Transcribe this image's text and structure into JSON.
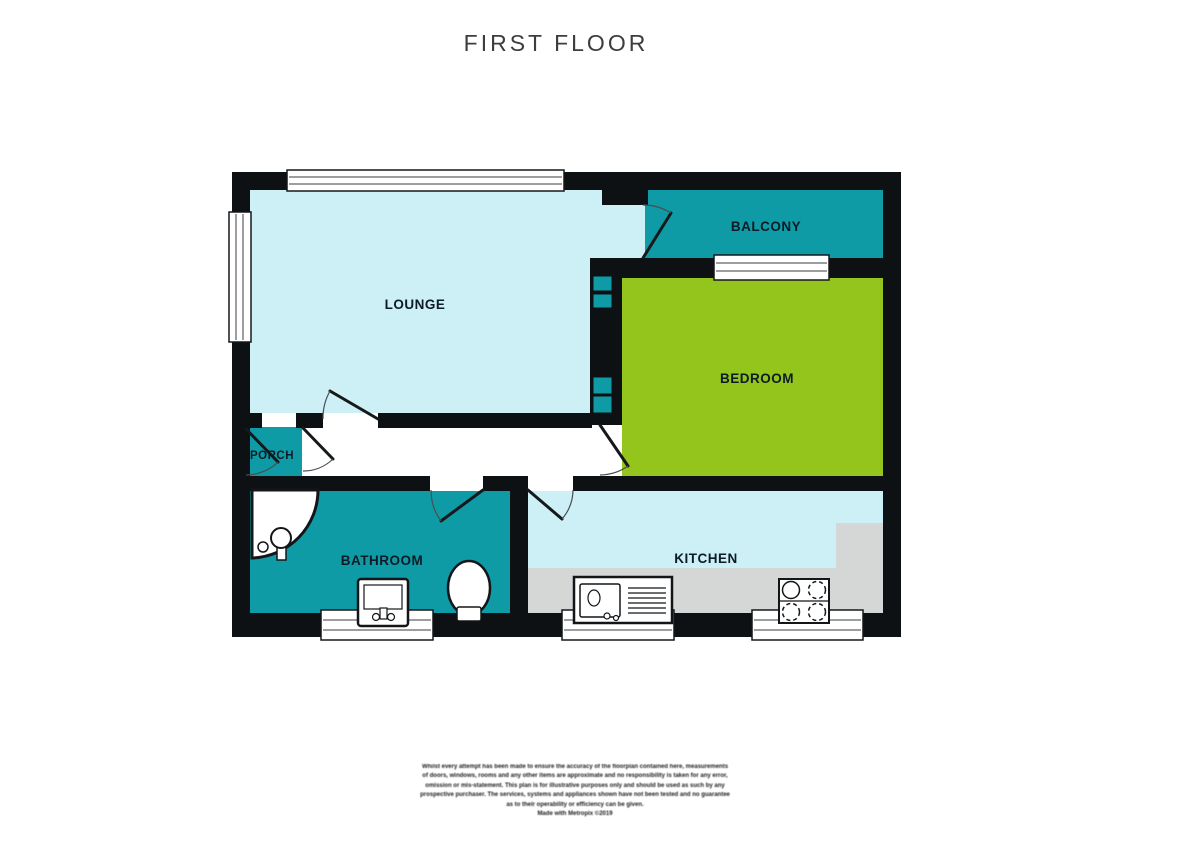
{
  "title": "FIRST FLOOR",
  "rooms": [
    {
      "id": "lounge",
      "label": "LOUNGE"
    },
    {
      "id": "balcony",
      "label": "BALCONY"
    },
    {
      "id": "bedroom",
      "label": "BEDROOM"
    },
    {
      "id": "porch",
      "label": "PORCH"
    },
    {
      "id": "bathroom",
      "label": "BATHROOM"
    },
    {
      "id": "kitchen",
      "label": "KITCHEN"
    }
  ],
  "fixtures": [
    "shower-icon",
    "bath-sink-icon",
    "toilet-icon",
    "kitchen-sink-icon",
    "hob-icon",
    "built-in-cupboards",
    "window-symbols",
    "door-swing-symbols"
  ],
  "colors": {
    "room_cyan": "#cdeff6",
    "room_teal": "#0e9ba6",
    "room_green": "#93c51c",
    "counter_gray": "#d5d7d7",
    "wall_black": "#0d1114",
    "label_ink": "#0d1b26",
    "title_ink": "#3d3d3d"
  },
  "disclaimer": {
    "lines": [
      "Whilst every attempt has been made to ensure the accuracy of the floorplan contained here, measurements",
      "of doors, windows, rooms and any other items are approximate and no responsibility is taken for any error,",
      "omission or mis-statement. This plan is for illustrative purposes only and should be used as such by any",
      "prospective purchaser. The services, systems and appliances shown have not been tested and no guarantee",
      "as to their operability or efficiency can be given.",
      "Made with Metropix ©2019"
    ]
  }
}
